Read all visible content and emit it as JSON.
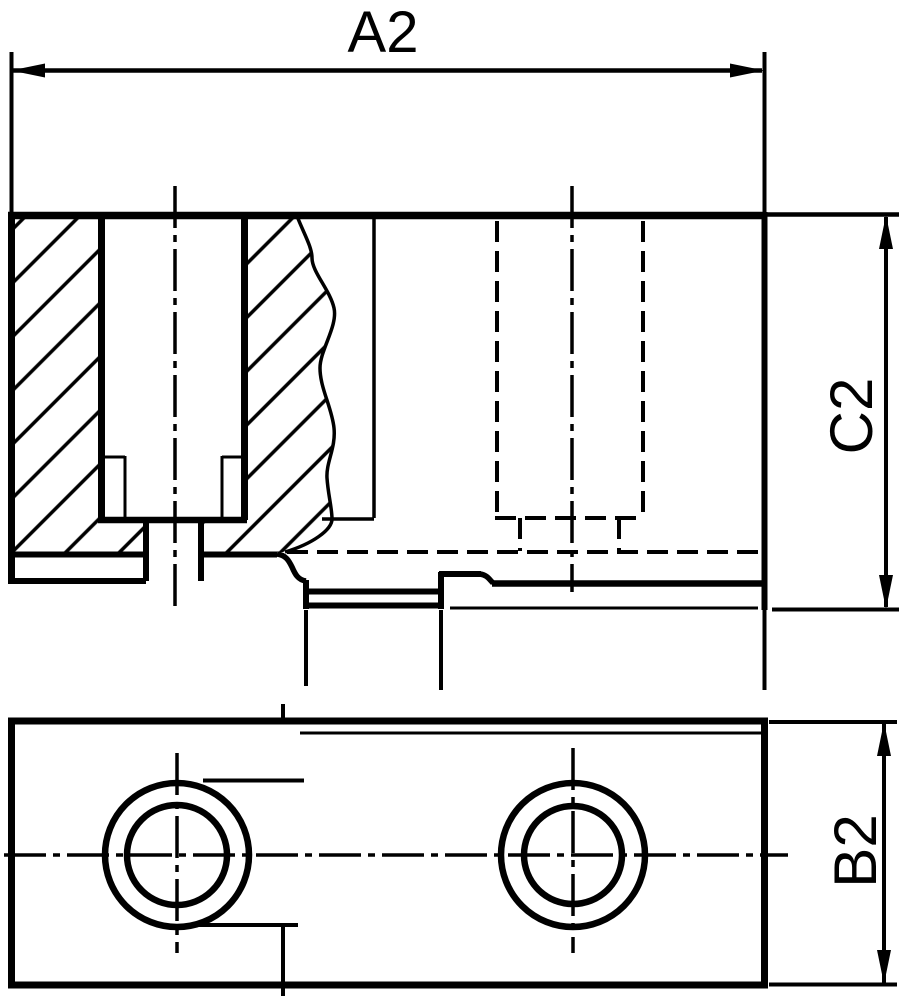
{
  "drawing": {
    "type": "technical-drawing",
    "views": {
      "section_view": "sectioned side view of chuck jaw with counterbored mounting holes",
      "bottom_view": "bottom view with two counterbored holes"
    },
    "dimensions": {
      "width_label": "A2",
      "height_label": "C2",
      "depth_label": "B2"
    },
    "colors": {
      "ink": "#000000",
      "background": "#ffffff"
    }
  }
}
